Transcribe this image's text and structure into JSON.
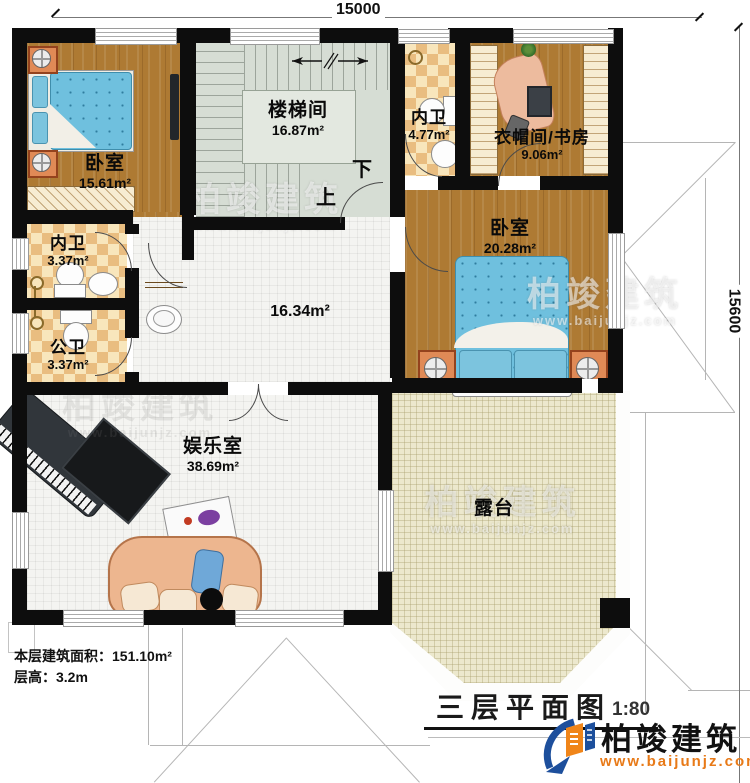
{
  "dimensions": {
    "top": "15000",
    "right": "15600"
  },
  "rooms": {
    "bedroom1": {
      "name": "卧室",
      "area": "15.61m²"
    },
    "stairwell": {
      "name": "楼梯间",
      "area": "16.87m²"
    },
    "bath_top": {
      "name": "内卫",
      "area": "4.77m²"
    },
    "study": {
      "name": "衣帽间/书房",
      "area": "9.06m²"
    },
    "bath_mid": {
      "name": "内卫",
      "area": "3.37m²"
    },
    "bath_public": {
      "name": "公卫",
      "area": "3.37m²"
    },
    "bedroom2": {
      "name": "卧室",
      "area": "20.28m²"
    },
    "hall": {
      "area": "16.34m²"
    },
    "entertainment": {
      "name": "娱乐室",
      "area": "38.69m²"
    },
    "terrace": {
      "name": "露台"
    }
  },
  "stairs": {
    "down": "下",
    "up": "上"
  },
  "info": {
    "floor_area_label": "本层建筑面积：",
    "floor_area_value": "151.10m²",
    "height_label": "层高：",
    "height_value": "3.2m"
  },
  "title": {
    "name": "三层平面图",
    "scale": "1:80"
  },
  "brand": {
    "name": "柏竣建筑",
    "url": "www.baijunjz.com"
  },
  "watermark": {
    "name": "柏竣建筑",
    "url": "www.baijunjz.com"
  },
  "colors": {
    "wall": "#0d0d0d",
    "wood_floor": "#ae7a33",
    "bath_tile": "#e9bd80",
    "stair": "#d6ddd4",
    "terrace": "#ece8cd",
    "bed_blue": "#6fc0de",
    "brand_blue": "#1d4f9c",
    "brand_orange": "#f08519"
  }
}
